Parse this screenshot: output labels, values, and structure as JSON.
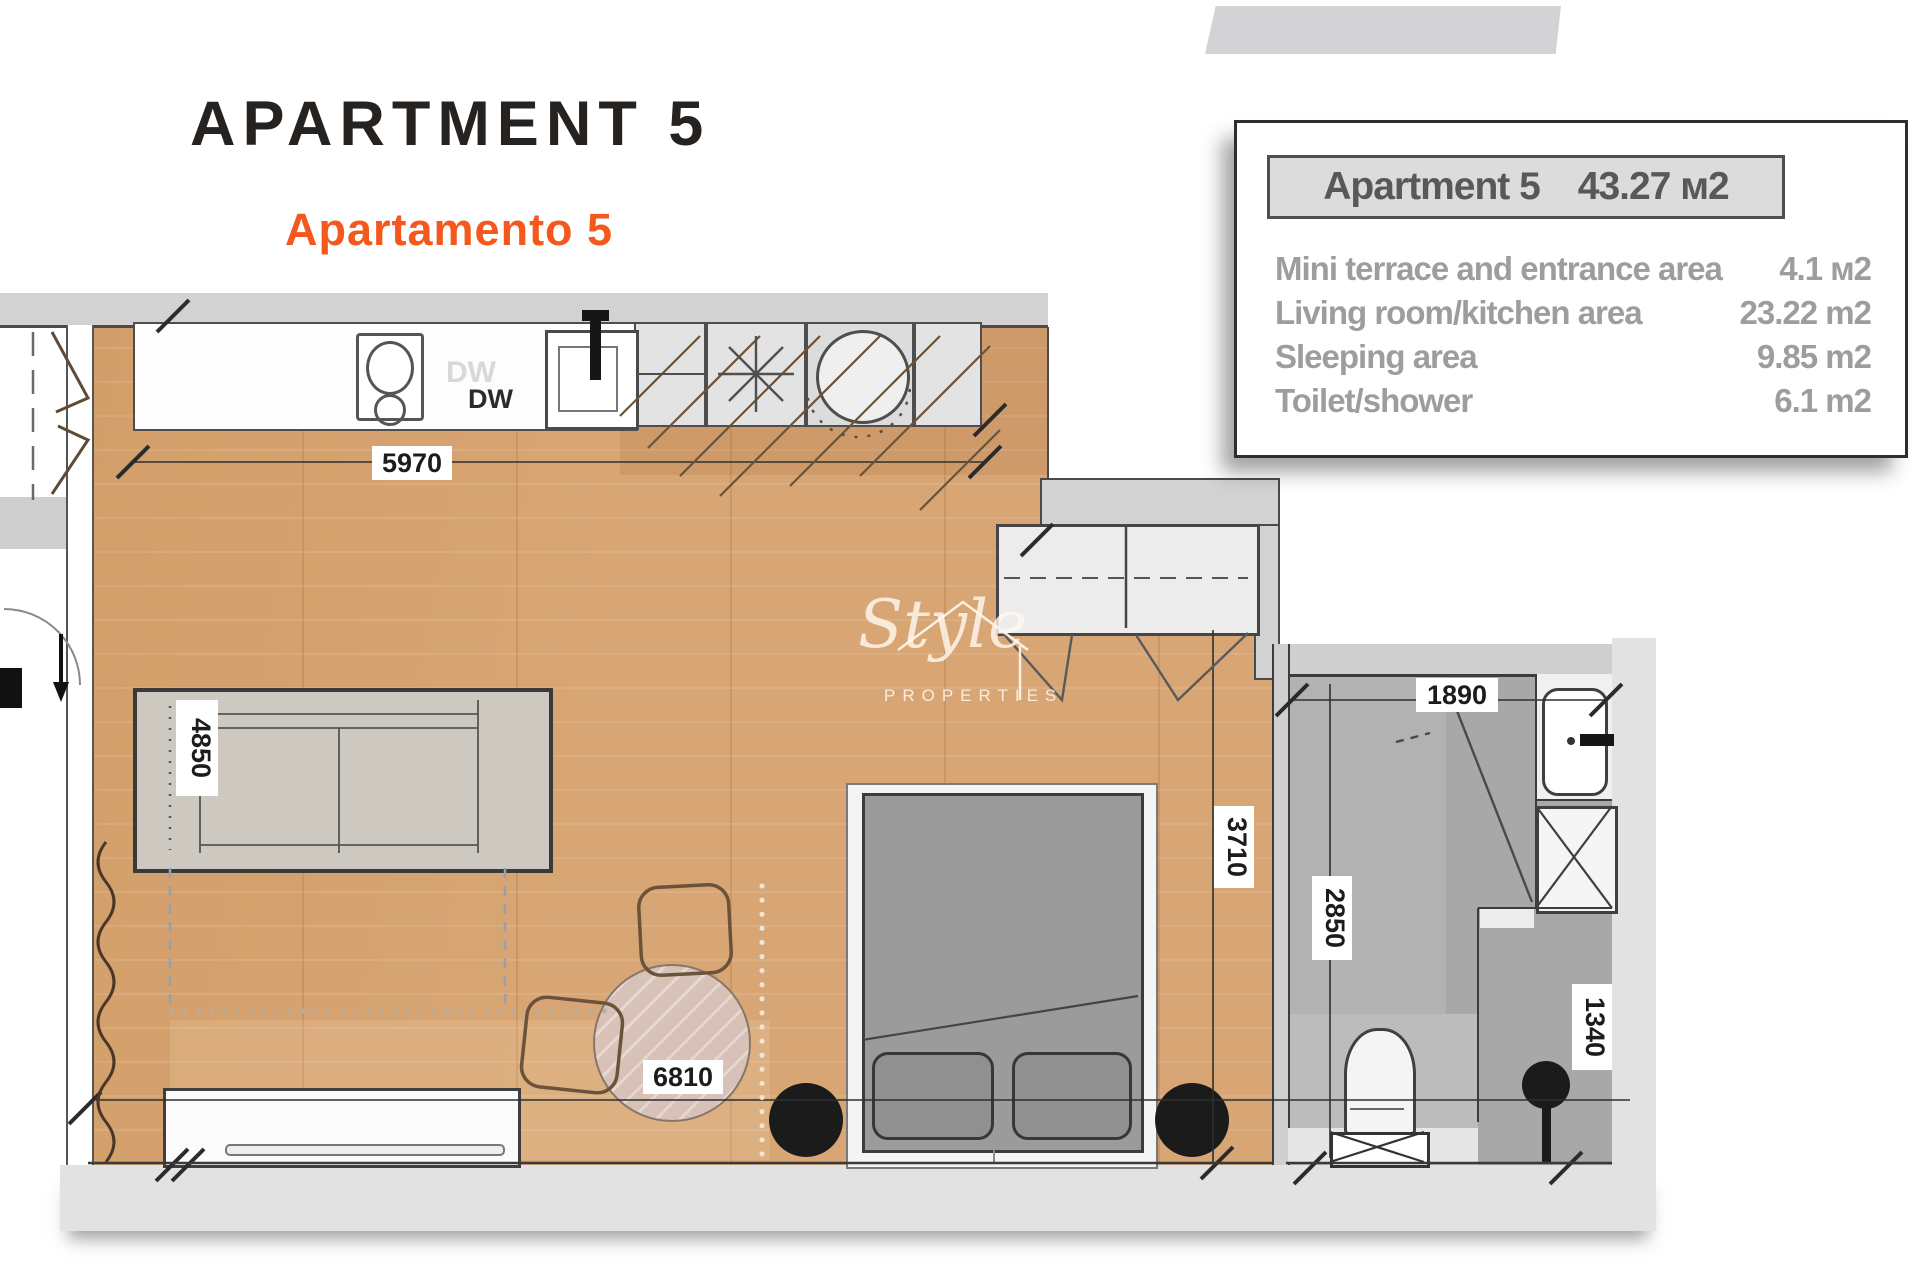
{
  "page": {
    "title": "APARTMENT 5",
    "subtitle": "Apartamento 5"
  },
  "info_box": {
    "header": {
      "name": "Apartment 5",
      "area": "43.27 м2"
    },
    "rows": [
      {
        "label": "Mini terrace and entrance area",
        "value": "4.1 м2"
      },
      {
        "label": "Living room/kitchen area",
        "value": "23.22 m2"
      },
      {
        "label": "Sleeping area",
        "value": "9.85 m2"
      },
      {
        "label": "Toilet/shower",
        "value": "6.1 m2"
      }
    ]
  },
  "plan": {
    "dimensions": {
      "kitchen_width": "5970",
      "sofa_length": "4850",
      "dining_zone": "6810",
      "sleeping_width": "3710",
      "bathroom_width": "1890",
      "bathroom_depth": "2850",
      "toilet_zone_width": "1340"
    },
    "labels": {
      "dishwasher_ghost": "DW",
      "dishwasher": "DW"
    },
    "watermark": {
      "script": "Style",
      "caption": "PROPERTIES"
    }
  },
  "colors": {
    "accent_orange": "#f4581c",
    "title_black": "#262220",
    "wood": "#d8a674",
    "wall_gray": "#d2d2d2",
    "bath_floor": "#a8a8a8",
    "info_text_gray": "#9d9d9d",
    "column_black": "#1b1b1b"
  }
}
